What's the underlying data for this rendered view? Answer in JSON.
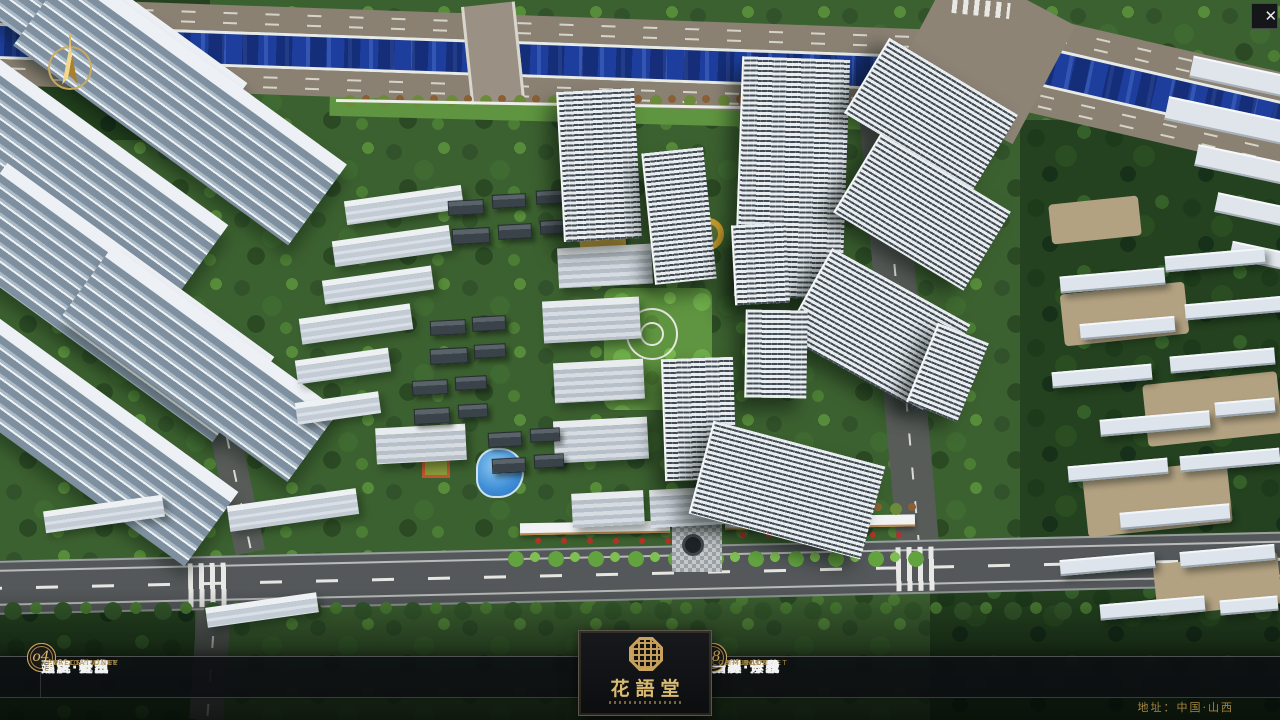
{
  "window": {
    "close": "✕"
  },
  "logo": {
    "title": "花語堂"
  },
  "menu": {
    "items": [
      {
        "num": "o1",
        "cn": "品牌·介绍",
        "en": "BRAND SUPPORT"
      },
      {
        "num": "o2",
        "cn": "区位·价值",
        "en": "LOCATION VALUE"
      },
      {
        "num": "o3",
        "cn": "项目·概况",
        "en": "PROJECT SURVEY"
      },
      {
        "num": "o4",
        "cn": "建筑·鉴赏",
        "en": "APPRECIATION"
      },
      {
        "num": "o5",
        "cn": "园林·景观",
        "en": "GARDEN STREET"
      },
      {
        "num": "o6",
        "cn": "精装·体验",
        "en": "EXPERIENCE"
      },
      {
        "num": "o7",
        "cn": "户型·分布",
        "en": "SHOW ROOM"
      },
      {
        "num": "o8",
        "cn": "一房·一景",
        "en": "COMMUNITY"
      }
    ]
  },
  "footer": {
    "address": "地址：中国·山西"
  },
  "theme": {
    "gold": "#c9a35c",
    "bar_bg": "#0d0f12",
    "river_blue": "#1d3e9c",
    "road_grey": "#54585a"
  }
}
